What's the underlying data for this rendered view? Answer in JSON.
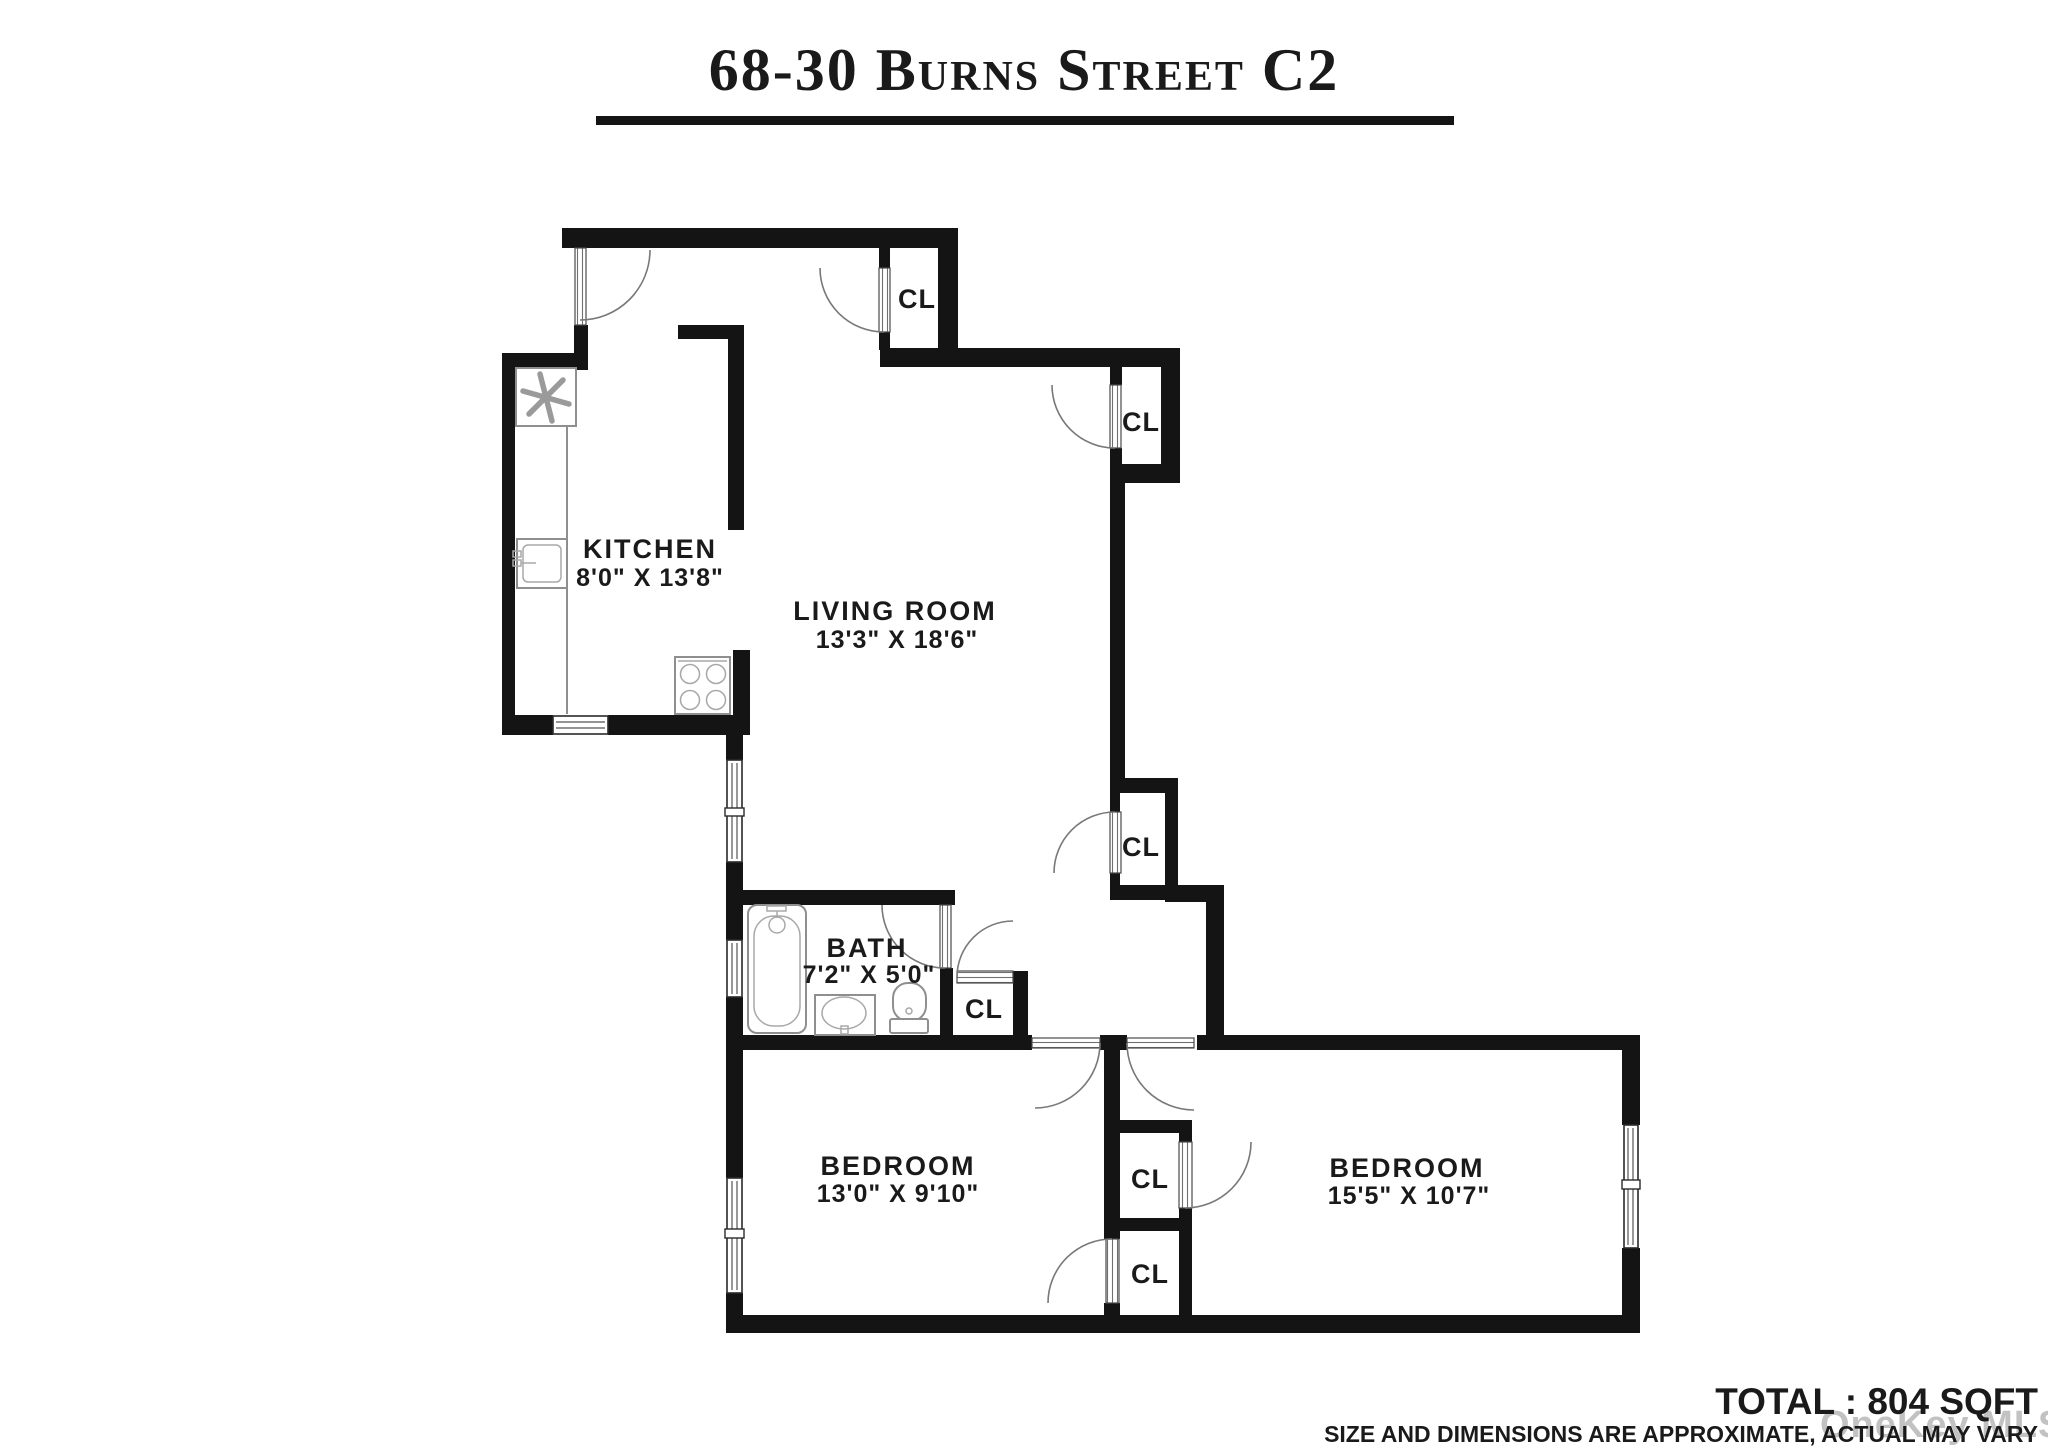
{
  "title": "68-30 Burns Street C2",
  "rooms": {
    "kitchen": {
      "name": "KITCHEN",
      "dims": "8'0\" X 13'8\""
    },
    "living": {
      "name": "LIVING ROOM",
      "dims": "13'3\" X 18'6\""
    },
    "bath": {
      "name": "BATH",
      "dims": "7'2\" X 5'0\""
    },
    "bedroom1": {
      "name": "BEDROOM",
      "dims": "13'0\" X 9'10\""
    },
    "bedroom2": {
      "name": "BEDROOM",
      "dims": "15'5\" X 10'7\""
    }
  },
  "closets": {
    "label": "CL",
    "count": 6
  },
  "footer": {
    "total": "TOTAL : 804 SQFT",
    "disclaimer": "SIZE AND DIMENSIONS ARE APPROXIMATE, ACTUAL MAY VARY"
  },
  "watermark": "OneKey MLS",
  "colors": {
    "wall": "#141414",
    "fixture": "#8f8f8f",
    "watermark": "#b4b4b4",
    "background": "#ffffff"
  }
}
